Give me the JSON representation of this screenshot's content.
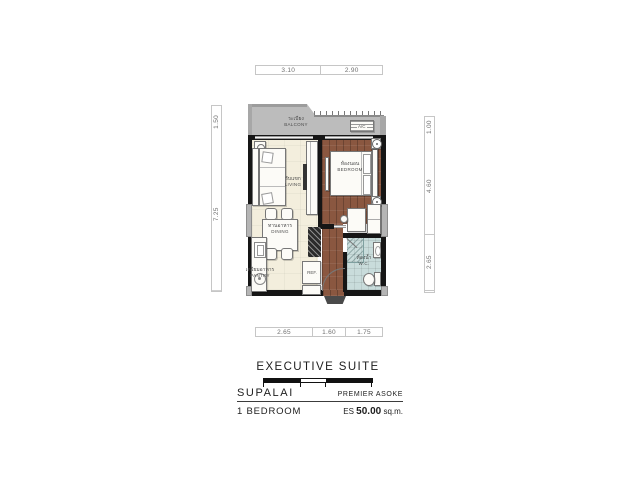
{
  "plan": {
    "rooms": {
      "balcony": {
        "th": "ระเบียง",
        "en": "BALCONY"
      },
      "living": {
        "th": "รับแขก",
        "en": "LIVING"
      },
      "dining": {
        "th": "ทานอาหาร",
        "en": "DINING"
      },
      "bedroom": {
        "th": "ห้องนอน",
        "en": "BEDROOM"
      },
      "wc": {
        "th": "ห้องน้ำ",
        "en": "W.C."
      },
      "pantry": {
        "th": "เตรียมอาหาร",
        "en": "PANTRY"
      }
    },
    "equipment": {
      "refrigerator": "REF.",
      "air_conditioner": "A/C"
    },
    "dimensions_m": {
      "top": [
        "3.10",
        "2.90"
      ],
      "left": [
        "1.50",
        "7.25"
      ],
      "right": [
        "1.00",
        "4.60",
        "2.65"
      ],
      "bottom": [
        "2.65",
        "1.60",
        "1.75"
      ]
    }
  },
  "footer": {
    "unit_type": "EXECUTIVE SUITE",
    "brand": "SUPALAI",
    "project": "PREMIER ASOKE",
    "bedrooms": "1 BEDROOM",
    "area_prefix": "ES",
    "area_value": "50.00",
    "area_unit": "sq.m."
  },
  "colors": {
    "wall": "#161616",
    "balcony_gray": "#bcbcbc",
    "living_cream": "#f3eedd",
    "bedroom_wood": "#8a5740",
    "wc_tile": "#c9dcdb",
    "dim_text": "#707070"
  }
}
